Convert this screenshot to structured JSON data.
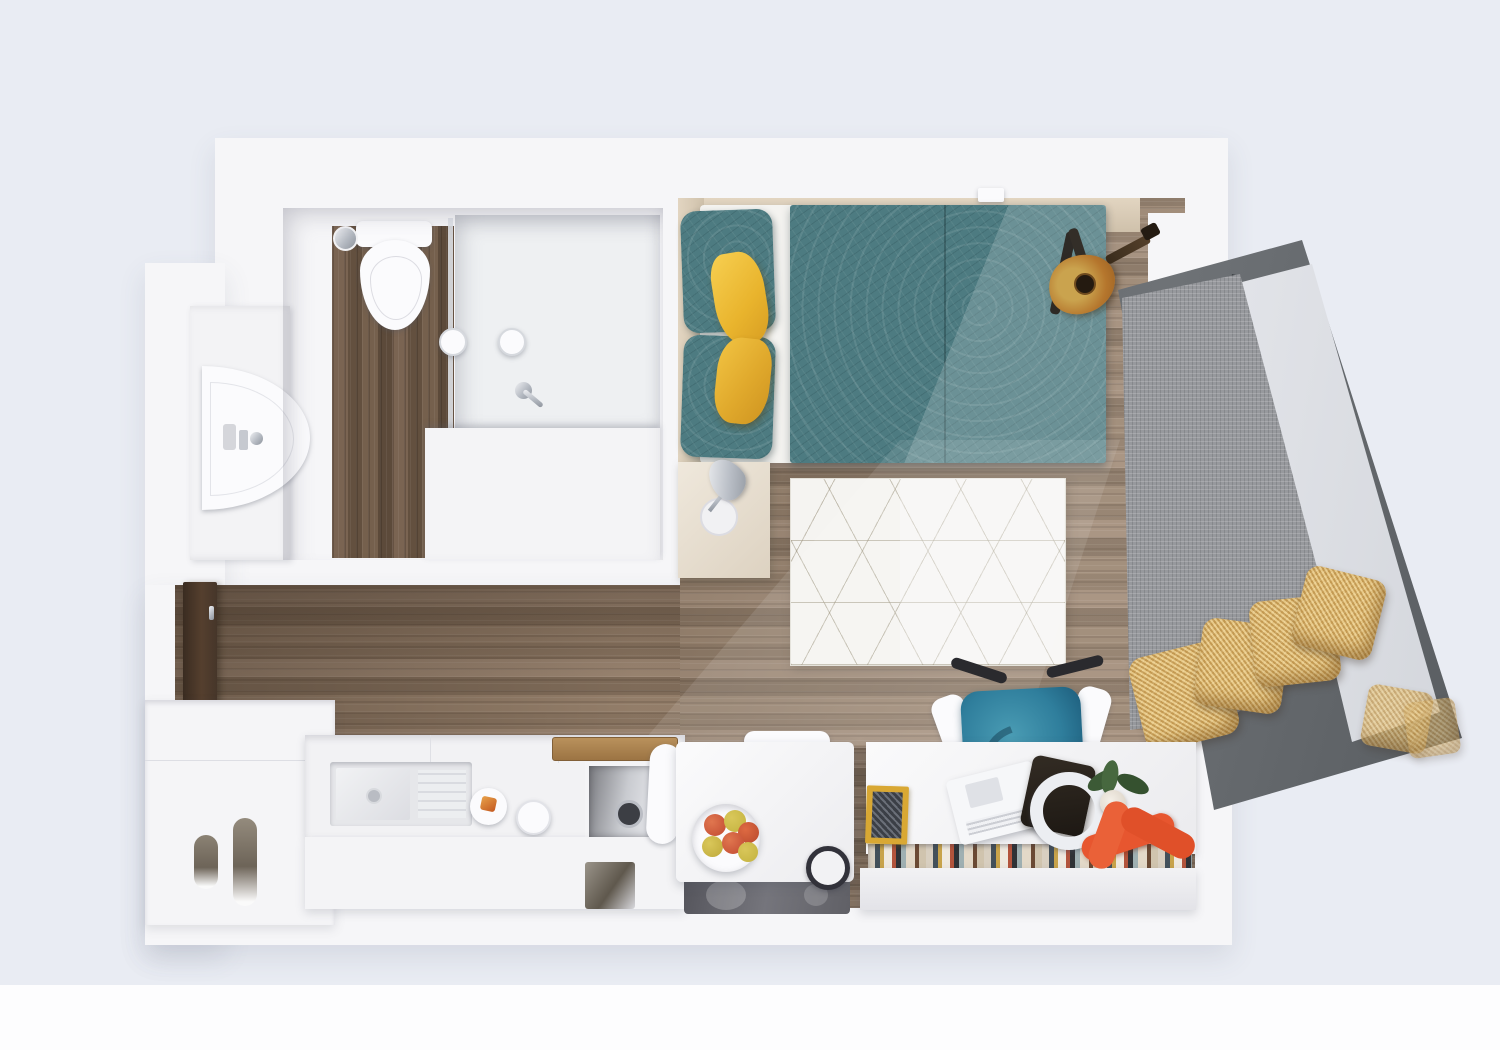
{
  "meta": {
    "type": "3d-floor-plan-render",
    "description": "Top-down 3D render of a furnished studio apartment",
    "visible_text": ""
  },
  "colors": {
    "bg": "#e9ecf3",
    "bg_bottom": "#fdfdfe",
    "wall": "#f6f6f8",
    "wood": "#96816d",
    "wood_dark": "#6f5b4a",
    "teal": "#4d7b81",
    "yellow": "#edbb33",
    "gold": "#d2a95e",
    "grayfab": "#97999d",
    "frame": "#565a5e",
    "glass": "#d9dbe1",
    "chair_teal": "#2f7e9c",
    "orange": "#e7562f",
    "beige": "#d6c8b2",
    "door": "#46362a",
    "apple_red": "#c14a31",
    "apple_green": "#c3b23e",
    "leaf_green": "#3c5a36"
  },
  "rooms": [
    {
      "id": "bathroom",
      "label": "Bathroom",
      "items": [
        "toilet",
        "toilet-roll-holder",
        "shower-enclosure",
        "shower-controls",
        "shower-mixer",
        "washbasin",
        "vanity-cabinet",
        "toiletries"
      ]
    },
    {
      "id": "bedroom",
      "label": "Bedroom",
      "items": [
        "double-bed",
        "leaf-pattern-duvet",
        "teal-pillows",
        "yellow-cushions",
        "headboard",
        "nightstand",
        "chrome-table-lamp",
        "acoustic-guitar",
        "guitar-stand",
        "light-switch"
      ]
    },
    {
      "id": "window-daybed",
      "label": "Window daybed",
      "items": [
        "angled-window-frame",
        "glass-panel",
        "grey-mattress",
        "gold-cushions"
      ],
      "gold_cushion_count": 4,
      "reflection_cushion_count": 2
    },
    {
      "id": "living-area",
      "label": "Living area",
      "items": [
        "geometric-rug",
        "desk",
        "office-chair",
        "laptop",
        "tablet",
        "headphones",
        "book-row",
        "yellow-book",
        "coral-ornament",
        "potted-plant",
        "bistro-table",
        "white-chair",
        "fruit-bowl",
        "mug",
        "glass-shelf"
      ]
    },
    {
      "id": "kitchen",
      "label": "Kitchen",
      "items": [
        "countertop",
        "sink",
        "drainer",
        "plate-with-toast",
        "kettle",
        "appliance-niche",
        "cutting-board",
        "base-cabinet",
        "handle-cutout"
      ]
    },
    {
      "id": "entry",
      "label": "Entry",
      "items": [
        "entrance-door",
        "door-handle",
        "wardrobe",
        "wardrobe-handle-slots"
      ]
    }
  ],
  "counts": {
    "apples_in_bowl": 6,
    "teal_pillows": 2,
    "yellow_bed_cushions": 2
  },
  "floor": {
    "main_area": "wood-horizontal-grain",
    "bathroom": "wood-vertical-grain"
  }
}
